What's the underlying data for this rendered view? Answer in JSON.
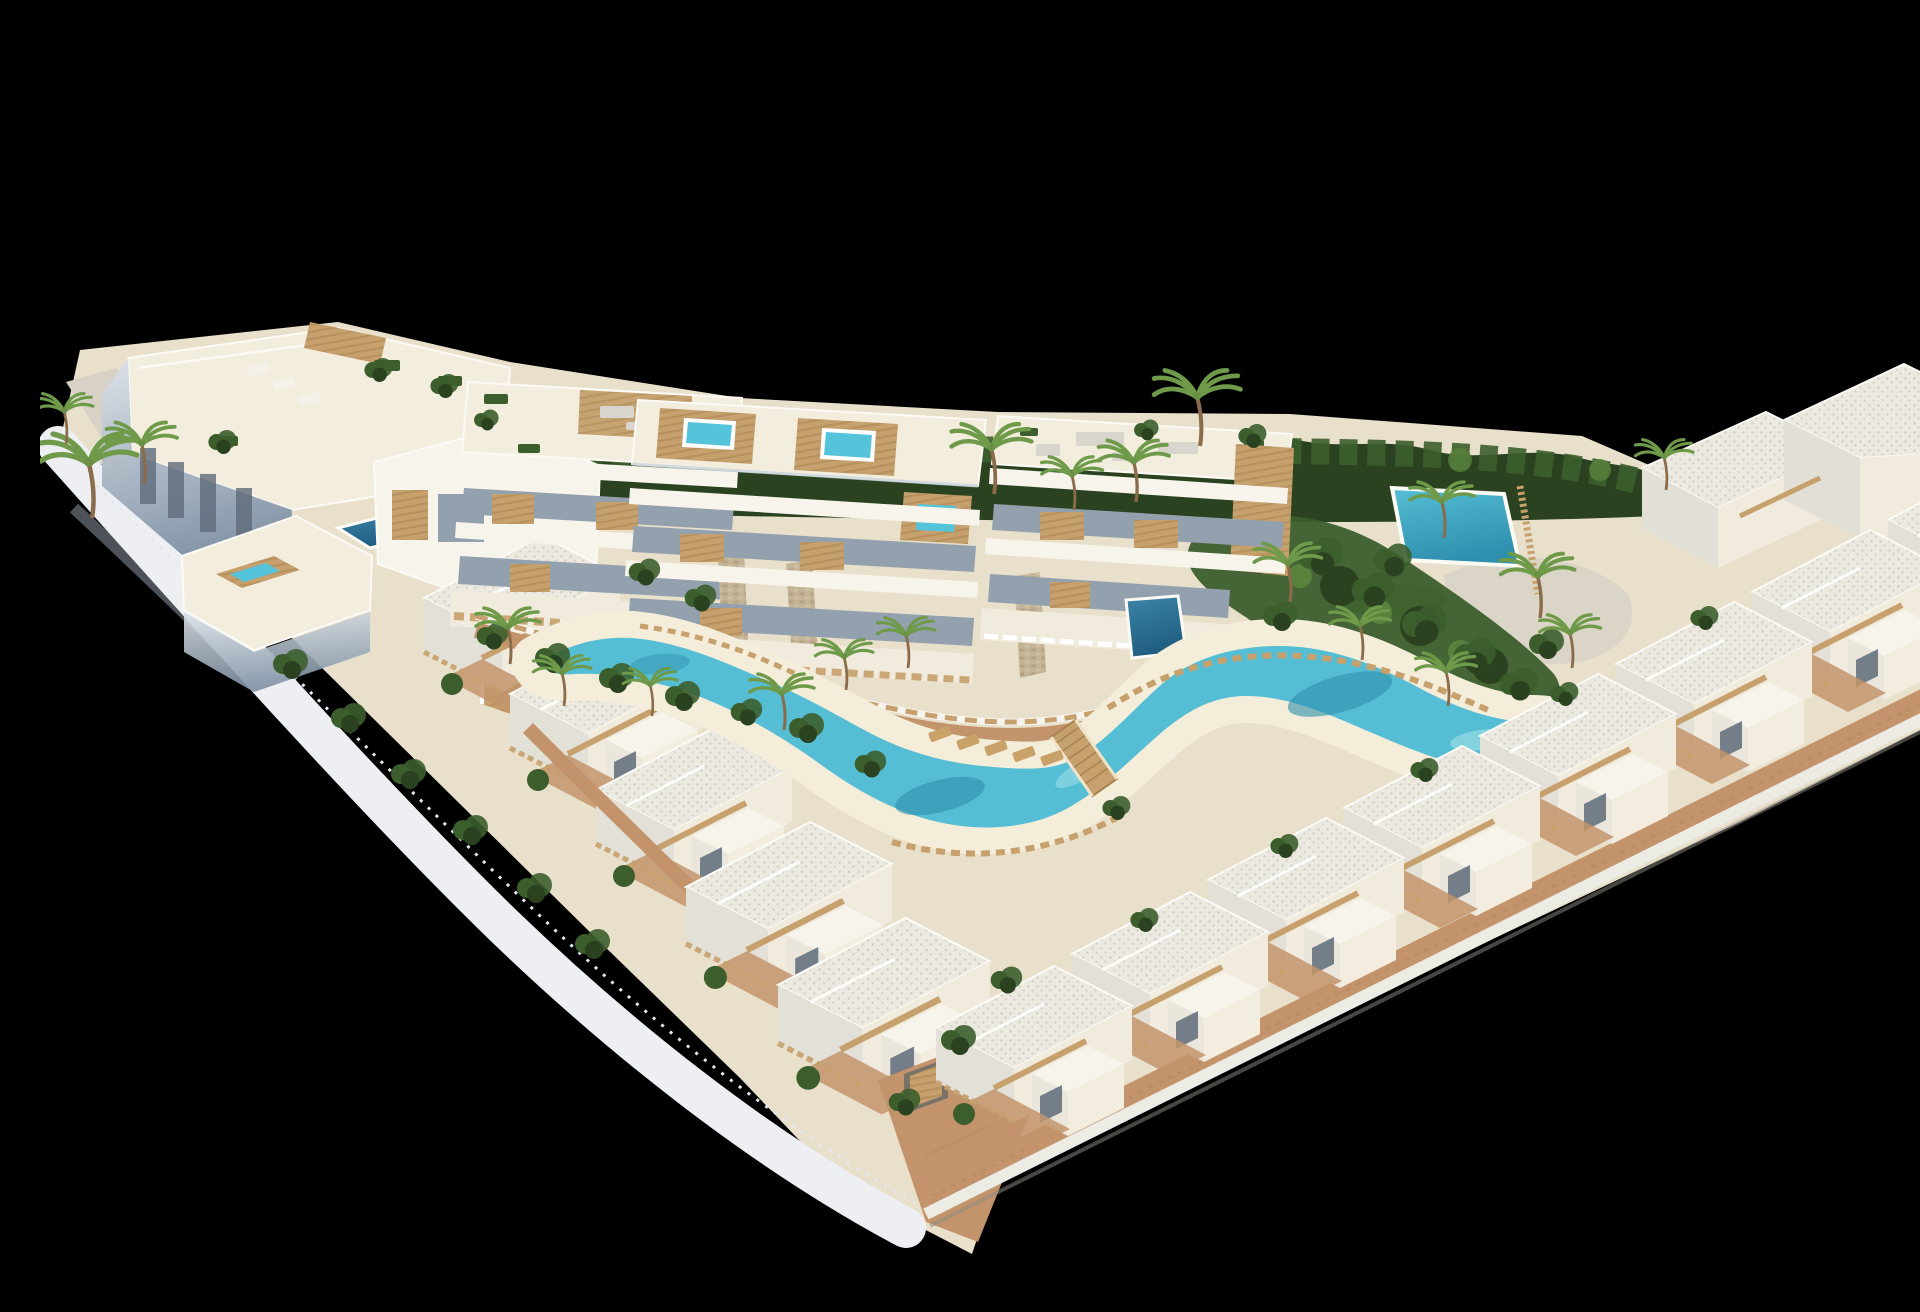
{
  "meta": {
    "title": "Aerial 3D architectural rendering of a white coastal residential resort",
    "description": "Isometric aerial 3D render on a black background: an L-shaped development of white Mediterranean villas and apartment blocks with rooftop terraces, pergolas and hot tubs, a winding turquoise lagoon pool edged by white sand beaches, sun loungers, a wooden footbridge, palm trees, dense hedges, wooden slat fences and terracotta walkways.",
    "render_style": "photorealistic 3D visualization, no text or UI elements",
    "background_color": "#000000",
    "canvas": {
      "width": 1920,
      "height": 1280
    }
  },
  "palette": {
    "background": "#000000",
    "building_white": "#f7f4ec",
    "building_cream": "#f1ebdd",
    "roof_deck": "#f3edde",
    "roof_base": "#ebe9e0",
    "roof_dot": "#d0cec5",
    "wall_shadow_light": "#dde2e8",
    "wall_shadow_deep": "#7e90a3",
    "wall_shadow_mid": "#b6c0cb",
    "window_glass": "#93a0ad",
    "window_dark": "#5f6b7a",
    "white_trim": "#fbfaf5",
    "wood": "#c6a06d",
    "wood_dark": "#a8824f",
    "stone": "#c4b497",
    "sand": "#e9e0cb",
    "beach": "#f3edda",
    "gravel": "#d7d2c5",
    "terracotta": "#c3946c",
    "hedge_dark": "#2a421f",
    "hedge_mid": "#3c5e2d",
    "leaf_light": "#59823c",
    "palm_green": "#6e9a4a",
    "grass": "#7da24c",
    "lagoon_light": "#a9e2e8",
    "lagoon_mid": "#55bed4",
    "lagoon_deep": "#2e8fae",
    "pool_dark": "#2a6a92",
    "jacuzzi": "#55c4da"
  },
  "scene": {
    "left_wing": {
      "label": "Left wing apartment buildings with roof terraces, pergola, plunge pools and a hot-tub deck",
      "buildings": 5,
      "plunge_pools": 2,
      "roof_hot_tub": true,
      "villa_units": [
        {
          "x": 384,
          "y": 520
        },
        {
          "x": 470,
          "y": 616
        },
        {
          "x": 556,
          "y": 712
        }
      ],
      "roof_loungers": [
        {
          "x": 218,
          "y": 354,
          "r": -16,
          "c": "#f4f1e8"
        },
        {
          "x": 244,
          "y": 368,
          "r": -16,
          "c": "#f4f1e8"
        },
        {
          "x": 270,
          "y": 382,
          "r": -16,
          "c": "#f4f1e8"
        }
      ]
    },
    "center_apartments": {
      "label": "Three central apartment blocks with balconies, stone pillars and rooftop hot tubs",
      "blocks": 3,
      "rooftop_hot_tubs": 3,
      "stone_pillars": 3,
      "private_pools": {
        "dark": 3,
        "bright": 1
      }
    },
    "right_wing": {
      "label": "Right wing terraced townhouse villas with balconies and terracotta terraces",
      "count": 8,
      "units": [
        {
          "x": 1848,
          "y": 442
        },
        {
          "x": 1712,
          "y": 514
        },
        {
          "x": 1576,
          "y": 586
        },
        {
          "x": 1440,
          "y": 658
        },
        {
          "x": 1304,
          "y": 730
        },
        {
          "x": 1168,
          "y": 802
        },
        {
          "x": 1032,
          "y": 876
        },
        {
          "x": 896,
          "y": 950
        }
      ]
    },
    "apex": {
      "label": "Corner villas at the bottom apex with brick driveway and garage",
      "garage": true,
      "villa_units": [
        {
          "x": 646,
          "y": 806,
          "s": 1.05
        },
        {
          "x": 738,
          "y": 902,
          "s": 1.08
        }
      ]
    },
    "lagoon": {
      "label": "Winding lagoon-style community pool with white sand beach and wooden footbridge",
      "wooden_bridge": true,
      "loungers": [
        {
          "x": 900,
          "y": 718,
          "r": -20,
          "c": "#c9a269"
        },
        {
          "x": 928,
          "y": 726,
          "r": -20,
          "c": "#c9a269"
        },
        {
          "x": 956,
          "y": 732,
          "r": -20,
          "c": "#c9a269"
        },
        {
          "x": 984,
          "y": 738,
          "r": -20,
          "c": "#c9a269"
        },
        {
          "x": 1012,
          "y": 742,
          "r": -20,
          "c": "#c9a269"
        }
      ]
    },
    "vegetation": {
      "label": "Palm trees, perimeter hedge and shrubs",
      "palms": [
        {
          "x": 52,
          "y": 502,
          "s": 1.5
        },
        {
          "x": 104,
          "y": 468,
          "s": 1.1
        },
        {
          "x": 26,
          "y": 428,
          "s": 0.9
        },
        {
          "x": 470,
          "y": 648,
          "s": 1.0
        },
        {
          "x": 524,
          "y": 690,
          "s": 0.9
        },
        {
          "x": 612,
          "y": 700,
          "s": 0.85
        },
        {
          "x": 744,
          "y": 714,
          "s": 1.0
        },
        {
          "x": 806,
          "y": 674,
          "s": 0.9
        },
        {
          "x": 868,
          "y": 652,
          "s": 0.9
        },
        {
          "x": 954,
          "y": 478,
          "s": 1.25
        },
        {
          "x": 1034,
          "y": 494,
          "s": 0.95
        },
        {
          "x": 1096,
          "y": 486,
          "s": 1.1
        },
        {
          "x": 1160,
          "y": 430,
          "s": 1.35
        },
        {
          "x": 1250,
          "y": 586,
          "s": 1.05
        },
        {
          "x": 1322,
          "y": 644,
          "s": 0.95
        },
        {
          "x": 1408,
          "y": 690,
          "s": 0.95
        },
        {
          "x": 1500,
          "y": 602,
          "s": 1.15
        },
        {
          "x": 1532,
          "y": 652,
          "s": 0.95
        },
        {
          "x": 1404,
          "y": 522,
          "s": 1.0
        },
        {
          "x": 1626,
          "y": 474,
          "s": 0.9
        }
      ],
      "bushes": [
        {
          "x": 250,
          "y": 648
        },
        {
          "x": 308,
          "y": 702
        },
        {
          "x": 368,
          "y": 758
        },
        {
          "x": 430,
          "y": 814
        },
        {
          "x": 494,
          "y": 872
        },
        {
          "x": 552,
          "y": 928
        },
        {
          "x": 452,
          "y": 620,
          "s": 0.9
        },
        {
          "x": 512,
          "y": 642
        },
        {
          "x": 576,
          "y": 662
        },
        {
          "x": 642,
          "y": 680
        },
        {
          "x": 706,
          "y": 696,
          "s": 0.9
        },
        {
          "x": 766,
          "y": 712
        },
        {
          "x": 830,
          "y": 748,
          "s": 0.9
        },
        {
          "x": 1076,
          "y": 792,
          "s": 0.8
        },
        {
          "x": 1280,
          "y": 540,
          "s": 1.3
        },
        {
          "x": 1332,
          "y": 574,
          "s": 1.2
        },
        {
          "x": 1384,
          "y": 608,
          "s": 1.3
        },
        {
          "x": 1434,
          "y": 640,
          "s": 1.2
        },
        {
          "x": 1478,
          "y": 668,
          "s": 1.1
        },
        {
          "x": 1506,
          "y": 628
        },
        {
          "x": 1352,
          "y": 544,
          "s": 1.1
        },
        {
          "x": 1240,
          "y": 600
        },
        {
          "x": 918,
          "y": 1024
        },
        {
          "x": 966,
          "y": 964,
          "s": 0.9
        },
        {
          "x": 864,
          "y": 1086,
          "s": 0.9
        },
        {
          "x": 1104,
          "y": 904,
          "s": 0.8
        },
        {
          "x": 1244,
          "y": 830,
          "s": 0.8
        },
        {
          "x": 1384,
          "y": 754,
          "s": 0.8
        },
        {
          "x": 1524,
          "y": 678,
          "s": 0.8
        },
        {
          "x": 1664,
          "y": 602,
          "s": 0.8
        },
        {
          "x": 338,
          "y": 354,
          "s": 0.8
        },
        {
          "x": 404,
          "y": 370,
          "s": 0.8
        },
        {
          "x": 446,
          "y": 404,
          "s": 0.7
        },
        {
          "x": 182,
          "y": 426,
          "s": 0.8
        },
        {
          "x": 1212,
          "y": 420,
          "s": 0.8
        },
        {
          "x": 1106,
          "y": 414,
          "s": 0.7
        },
        {
          "x": 604,
          "y": 556,
          "s": 0.9
        },
        {
          "x": 660,
          "y": 582,
          "s": 0.9
        }
      ]
    },
    "perimeter": {
      "left": "white boundary wall with thin picket fence and shrub border",
      "bottom_right": "terracotta promenade over a white plinth wall",
      "top": "dense green hedge with scattered palms"
    }
  }
}
